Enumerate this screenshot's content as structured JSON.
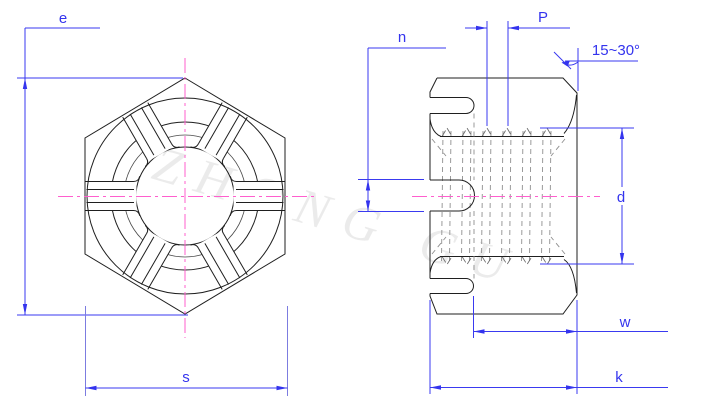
{
  "drawing": {
    "type": "castle-slotted-hex-nut-engineering-drawing",
    "watermark": {
      "text": "ZHONG GU"
    },
    "colors": {
      "outline": "#1f1f1f",
      "dimension": "#3434ee",
      "centerline": "#ff5fce",
      "thread": "#8f8f8f",
      "watermark": "#ebebeb",
      "background": "#ffffff"
    },
    "front_view": {
      "labels": {
        "e": "e",
        "s": "s"
      }
    },
    "side_view": {
      "labels": {
        "n": "n",
        "p": "P",
        "angle": "15~30°",
        "d": "d",
        "w": "w",
        "k": "k"
      }
    }
  }
}
